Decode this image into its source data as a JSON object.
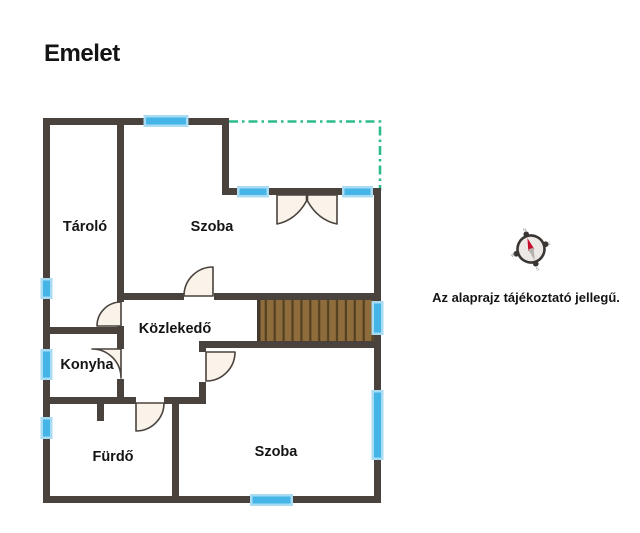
{
  "title": "Emelet",
  "note": "Az alaprajz tájékoztató jellegű.",
  "rooms": [
    {
      "name": "Tároló"
    },
    {
      "name": "Szoba"
    },
    {
      "name": "Közlekedő"
    },
    {
      "name": "Konyha"
    },
    {
      "name": "Fürdő"
    },
    {
      "name": "Szoba"
    }
  ],
  "compass": {
    "north": "N",
    "east": "E",
    "south": "S",
    "west": "W"
  },
  "colors": {
    "wall": "#4a423c",
    "window_fill": "#45b5e7",
    "window_frame": "#a9dbf3",
    "stairs_fill": "#8f6c3c",
    "stairs_step": "#54411f",
    "door_fill": "#faf3ea",
    "terrace_line": "#2bbb8d",
    "compass_needle": "#c8102e",
    "compass_tail": "#b5b1ad"
  }
}
